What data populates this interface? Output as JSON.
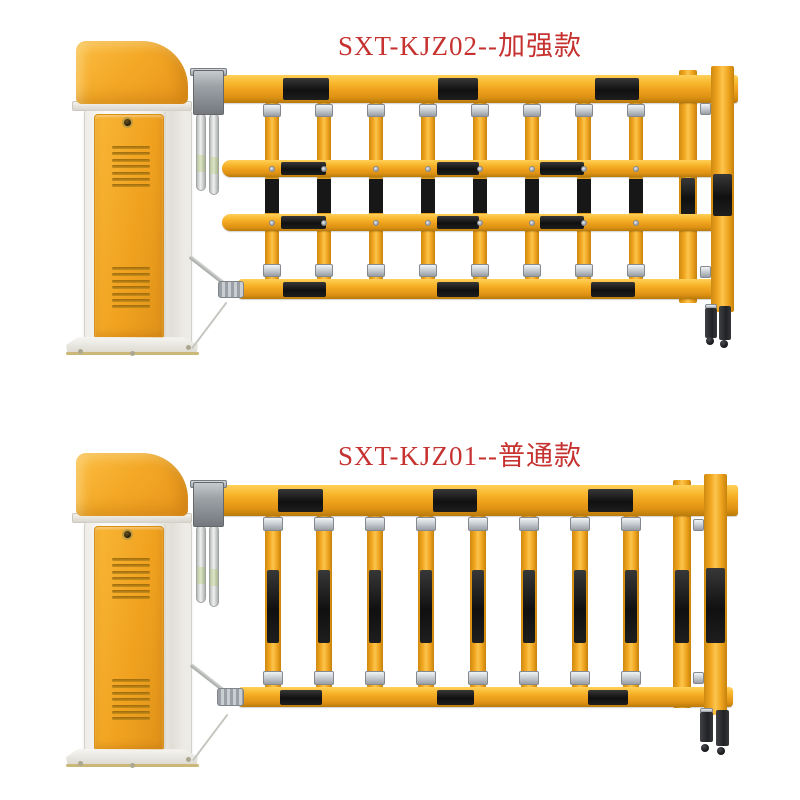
{
  "page": {
    "background": "#FFFFFF"
  },
  "products": [
    {
      "label": "SXT-KJZ02--加强款",
      "model": "SXT-KJZ02",
      "variant_name": "加强款",
      "description": "barrier gate with reinforced grid fence arm",
      "fence": {
        "horizontal_rails": 4,
        "vertical_pickets": 8,
        "stripe_pattern": "black-on-yellow"
      }
    },
    {
      "label": "SXT-KJZ01--普通款",
      "model": "SXT-KJZ01",
      "variant_name": "普通款",
      "description": "barrier gate with standard two-rail fence arm",
      "fence": {
        "horizontal_rails": 2,
        "vertical_pickets": 8,
        "stripe_pattern": "black-on-yellow"
      }
    }
  ],
  "colors": {
    "title_text": "#C63230",
    "rail_yellow": "#F0A51E",
    "rail_yellow_light": "#FBC04A",
    "rail_yellow_dark": "#C07E0C",
    "stripe_black": "#141414",
    "cabinet_cap_orange": "#F3A524",
    "cabinet_body_white": "#F4F3EF",
    "bracket_gray": "#8E9297",
    "clamp_silver": "#C7CBD0",
    "leg_black": "#26282C"
  }
}
